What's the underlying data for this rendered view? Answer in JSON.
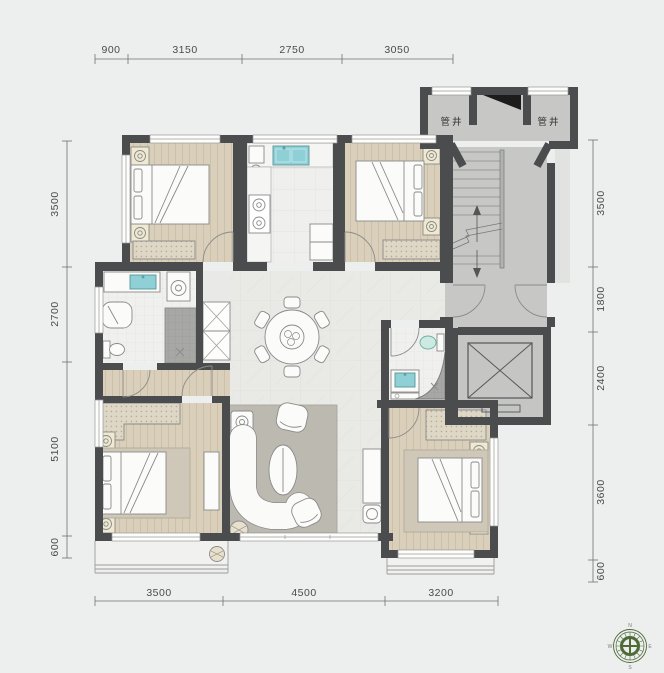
{
  "dimensions": {
    "top": [
      "900",
      "3150",
      "2750",
      "3050"
    ],
    "left": [
      "3500",
      "2700",
      "5100",
      "600"
    ],
    "right": [
      "3500",
      "1800",
      "2400",
      "3600",
      "600"
    ],
    "bottom": [
      "3500",
      "4500",
      "3200"
    ]
  },
  "labels": {
    "shaft_left": "管井",
    "shaft_right": "管井"
  },
  "compass": {
    "north": "N",
    "east": "E",
    "south": "S",
    "west": "W"
  },
  "colors": {
    "wall": "#4b4c4e",
    "wood_floor": "#d9cfba",
    "marble_floor": "#e9eae6",
    "stair_floor": "#c7c8c6",
    "accent_teal": "#8ed0d6",
    "rug": "#bcb9b1",
    "compass_green": "#4e6a37",
    "background": "#edefee"
  }
}
